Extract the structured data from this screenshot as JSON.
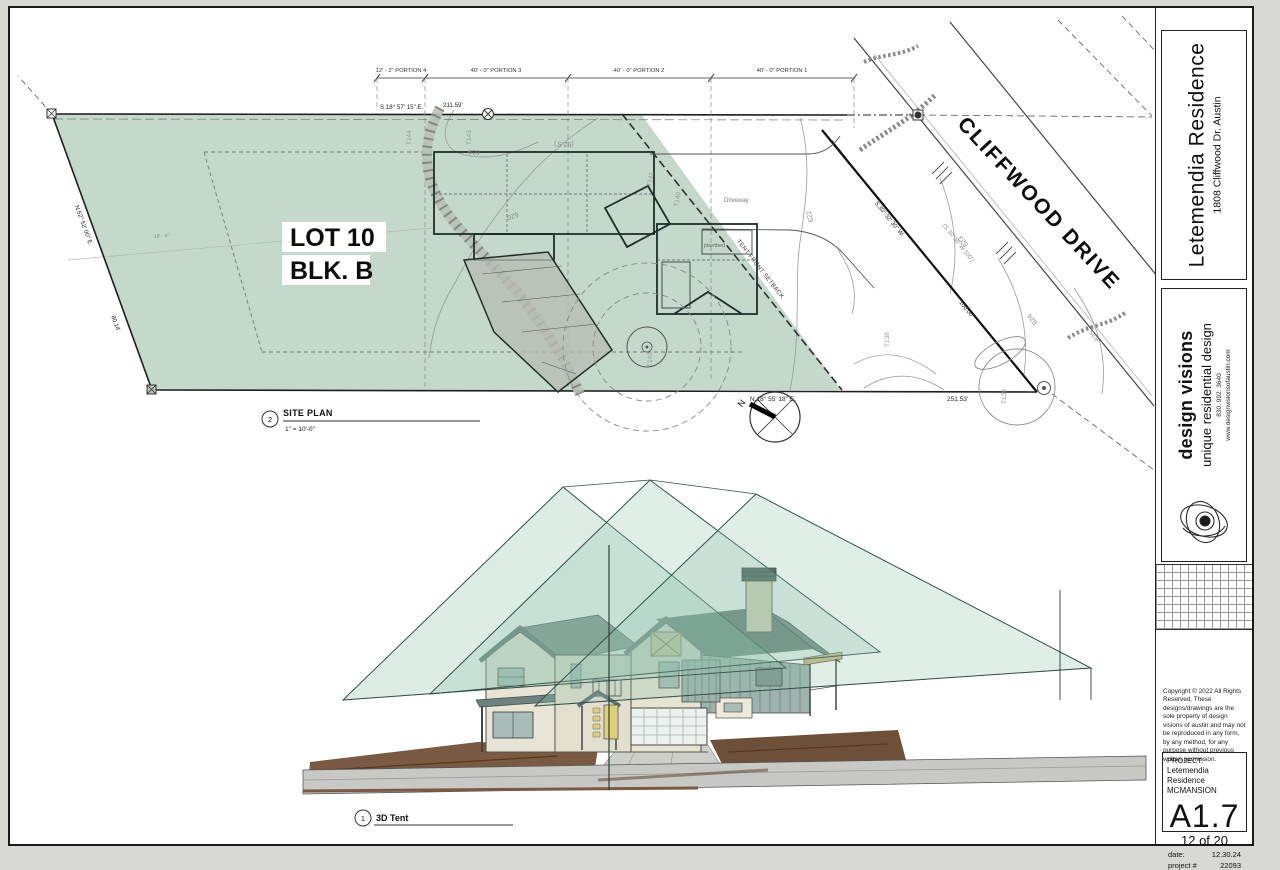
{
  "titleblock": {
    "project_name": "Letemendia Residence",
    "project_address": "1808 Cliffwood Dr. Austin",
    "firm_name": "design visions",
    "firm_tagline": "unique residential design",
    "firm_phone": "830. 992. 3640",
    "firm_web": "www.designvisionsofaustin.com",
    "copyright": "Copyright  ©  2022 All Rights Reserved.  These designs/drawings are the sole property of design visions of austin and may not be reproduced in any form, by any method, for any purpose without previous written permission.",
    "project_label": "PROJECT:",
    "project_line1": "Letemendia Residence",
    "project_line2": "MCMANSION",
    "sheet_number": "A1.7",
    "sheet_count": "12 of 20",
    "date_label": "date:",
    "date_value": "12.30.24",
    "project_num_label": "project #",
    "project_num_value": "22093"
  },
  "site_plan": {
    "callout_number": "2",
    "title": "SITE PLAN",
    "scale": "1\" = 10'-0\"",
    "lot_line1": "LOT 10",
    "lot_line2": "BLK. B",
    "street_name": "CLIFFWOOD DRIVE",
    "setback_label": "TENT FRONT SETBACK",
    "driveway_label": "Driveway",
    "plantbed_label": "plantbed",
    "north_label": "N",
    "dim_interior": "16' - 6\"",
    "dim_paren": "(92.5')",
    "portions": [
      "12' - 2\" PORTION 4",
      "40' - 0\" PORTION 3",
      "40' - 0\" PORTION 2",
      "40' - 0\" PORTION 1"
    ],
    "bearings": {
      "top": "S.18° 57' 15\".E.",
      "top_len": "211.59'",
      "bottom": "N.18° 55' 18\" E.",
      "bottom_len": "251.53'",
      "west": "N.52° 52' 00\" E.",
      "west_len": "80.14'",
      "east": "S.30° 32' 30\" W.",
      "east_len": "100.00'",
      "street": "(S 30°30' W   100')"
    },
    "contours": [
      "619",
      "620",
      "622",
      "623",
      "624",
      "625"
    ],
    "trees": [
      "T144",
      "T143",
      "T142",
      "T141",
      "T140",
      "T139",
      "T138"
    ]
  },
  "view3d": {
    "callout_number": "1",
    "title": "3D Tent"
  },
  "colors": {
    "lot_green": "#c5d8cc",
    "tent_green": "#8fc2ab",
    "roof_slate": "#5f7370",
    "wall_cream": "#e9e5d6",
    "dirt_brown": "#7a5a42",
    "road_gray": "#c8c8c5",
    "door_yellow": "#e0cf7a"
  }
}
